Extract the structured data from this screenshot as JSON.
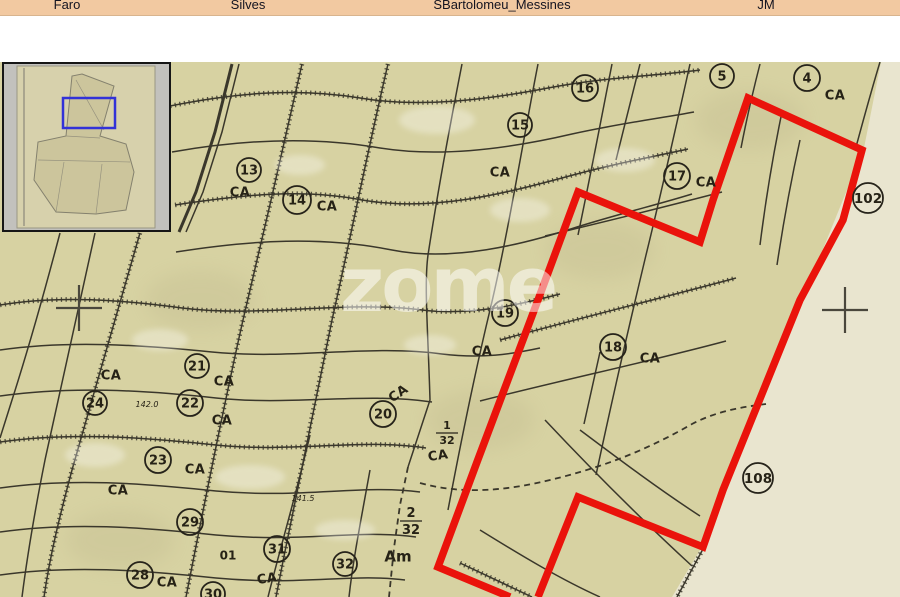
{
  "header": {
    "items": [
      {
        "label": "Faro"
      },
      {
        "label": "Silves"
      },
      {
        "label": "SBartolomeu_Messines"
      },
      {
        "label": "JM"
      }
    ],
    "bg_color": "#f2c9a1"
  },
  "minimap": {
    "highlight_color": "#3232d8"
  },
  "watermark": {
    "text": "zome"
  },
  "map": {
    "colors": {
      "paper": "#d7d2a2",
      "paper_light": "#e9e5cf",
      "line": "#3a372b",
      "cross": "#4a473c",
      "selection_red": "#ea130b"
    },
    "selection_outline_points": "538,597 578,497 703,547 723,490 800,300 843,220 862,150 748,98 713,200 700,242 578,192 538,300 477,462 438,567 510,597",
    "light_region_points": "881,62 900,62 900,597 672,597 703,545 864,148",
    "crosses": [
      {
        "x": 79,
        "y": 308
      },
      {
        "x": 845,
        "y": 310
      }
    ],
    "parcels": [
      {
        "n": "13",
        "x": 249,
        "y": 170,
        "r": 12
      },
      {
        "n": "14",
        "x": 297,
        "y": 200,
        "r": 14
      },
      {
        "n": "15",
        "x": 520,
        "y": 125,
        "r": 12
      },
      {
        "n": "16",
        "x": 585,
        "y": 88,
        "r": 13
      },
      {
        "n": "5",
        "x": 722,
        "y": 76,
        "r": 12
      },
      {
        "n": "4",
        "x": 807,
        "y": 78,
        "r": 13
      },
      {
        "n": "17",
        "x": 677,
        "y": 176,
        "r": 13
      },
      {
        "n": "102",
        "x": 868,
        "y": 198,
        "r": 15
      },
      {
        "n": "19",
        "x": 505,
        "y": 313,
        "r": 13
      },
      {
        "n": "18",
        "x": 613,
        "y": 347,
        "r": 13
      },
      {
        "n": "21",
        "x": 197,
        "y": 366,
        "r": 12
      },
      {
        "n": "24",
        "x": 95,
        "y": 403,
        "r": 12
      },
      {
        "n": "22",
        "x": 190,
        "y": 403,
        "r": 13
      },
      {
        "n": "20",
        "x": 383,
        "y": 414,
        "r": 13
      },
      {
        "n": "23",
        "x": 158,
        "y": 460,
        "r": 13
      },
      {
        "n": "29",
        "x": 190,
        "y": 522,
        "r": 13
      },
      {
        "n": "31",
        "x": 277,
        "y": 549,
        "r": 13
      },
      {
        "n": "32",
        "x": 345,
        "y": 564,
        "r": 12
      },
      {
        "n": "28",
        "x": 140,
        "y": 575,
        "r": 13
      },
      {
        "n": "30",
        "x": 213,
        "y": 594,
        "r": 12
      },
      {
        "n": "108",
        "x": 758,
        "y": 478,
        "r": 15
      }
    ],
    "ca_labels": [
      {
        "t": "CA",
        "x": 240,
        "y": 192,
        "rot": 0
      },
      {
        "t": "CA",
        "x": 327,
        "y": 206,
        "rot": 0
      },
      {
        "t": "CA",
        "x": 500,
        "y": 172,
        "rot": 0
      },
      {
        "t": "CA",
        "x": 706,
        "y": 182,
        "rot": 0
      },
      {
        "t": "CA",
        "x": 835,
        "y": 95,
        "rot": 0
      },
      {
        "t": "CA",
        "x": 650,
        "y": 358,
        "rot": 0
      },
      {
        "t": "CA",
        "x": 482,
        "y": 351,
        "rot": 0
      },
      {
        "t": "CA",
        "x": 224,
        "y": 381,
        "rot": 0
      },
      {
        "t": "CA",
        "x": 111,
        "y": 375,
        "rot": 0
      },
      {
        "t": "CA",
        "x": 222,
        "y": 420,
        "rot": 0
      },
      {
        "t": "CA",
        "x": 195,
        "y": 469,
        "rot": 0
      },
      {
        "t": "CA",
        "x": 118,
        "y": 490,
        "rot": 0
      },
      {
        "t": "CA",
        "x": 167,
        "y": 582,
        "rot": 0
      },
      {
        "t": "CA",
        "x": 267,
        "y": 578,
        "rot": -8
      },
      {
        "t": "CA",
        "x": 398,
        "y": 393,
        "rot": -35
      },
      {
        "t": "CA",
        "x": 438,
        "y": 455,
        "rot": -8
      }
    ],
    "annotations": [
      {
        "t": "142.0",
        "x": 147,
        "y": 404,
        "s": 8,
        "italic": true
      },
      {
        "t": "141.5",
        "x": 303,
        "y": 498,
        "s": 8,
        "italic": true
      },
      {
        "t": "01",
        "x": 228,
        "y": 555,
        "s": 12,
        "italic": false
      },
      {
        "t": "Am",
        "x": 398,
        "y": 556,
        "s": 15,
        "italic": false
      }
    ],
    "fractions": [
      {
        "num": "1",
        "den": "32",
        "x": 447,
        "y": 433,
        "s": 11
      },
      {
        "num": "2",
        "den": "32",
        "x": 411,
        "y": 521,
        "s": 13
      }
    ],
    "lines": [
      {
        "d": "M232,64 L215,132 L196,192 L179,232",
        "k": "thick"
      },
      {
        "d": "M239,64 L222,132 L203,192 L186,232",
        "k": "thin"
      },
      {
        "d": "M140,233 C120,300 95,390 72,470 C60,515 50,555 44,597",
        "k": "tick"
      },
      {
        "d": "M95,233 C80,300 62,380 45,460 C35,510 28,550 22,597",
        "k": "thin"
      },
      {
        "d": "M60,233 C45,290 28,350 12,400 L0,438",
        "k": "thin"
      },
      {
        "d": "M302,64 C285,140 262,240 243,320 C225,400 205,500 186,597",
        "k": "tick"
      },
      {
        "d": "M388,64 C370,140 350,240 332,320 C315,400 295,500 276,597",
        "k": "tick"
      },
      {
        "d": "M462,64 C450,125 438,190 428,255 C424,285 428,330 430,400 L408,467",
        "k": "thin"
      },
      {
        "d": "M408,467 L400,505 L394,548 L389,597",
        "k": "dash"
      },
      {
        "d": "M538,64 C524,135 508,235 490,310 C478,360 465,420 448,510",
        "k": "thin"
      },
      {
        "d": "M612,64 C601,120 590,178 578,235",
        "k": "thin"
      },
      {
        "d": "M640,64 C632,95 624,128 616,160",
        "k": "thin"
      },
      {
        "d": "M690,64 C678,118 662,190 646,255 C630,322 612,400 596,475",
        "k": "thin"
      },
      {
        "d": "M760,64 C752,95 746,122 741,148",
        "k": "thin"
      },
      {
        "d": "M880,62 C870,95 862,125 856,147",
        "k": "thin"
      },
      {
        "d": "M310,435 C296,495 281,545 268,597",
        "k": "thin"
      },
      {
        "d": "M370,470 C361,520 353,560 349,597",
        "k": "thin"
      },
      {
        "d": "M170,106 C240,92 300,88 360,98 C420,108 485,100 548,88 C605,77 655,76 700,70",
        "k": "tick"
      },
      {
        "d": "M172,152 C240,140 312,136 380,148 C442,158 512,148 572,134 C622,123 662,118 694,112",
        "k": "thin"
      },
      {
        "d": "M175,205 C242,195 302,188 362,200 C432,212 502,194 562,178 C612,164 652,157 688,149",
        "k": "tick"
      },
      {
        "d": "M176,252 C252,240 322,236 392,250 C452,262 522,245 577,227 C622,213 660,204 692,194",
        "k": "thin"
      },
      {
        "d": "M0,305 C60,295 122,300 182,308 C262,318 342,300 422,310 C472,316 522,304 560,294",
        "k": "tick"
      },
      {
        "d": "M0,350 C70,340 142,345 212,352 C292,360 372,344 442,354 C482,359 512,354 540,348",
        "k": "thin"
      },
      {
        "d": "M0,396 C70,386 142,390 216,398 C292,406 362,392 432,402",
        "k": "thin"
      },
      {
        "d": "M0,442 C70,432 142,437 216,445 C292,453 362,438 426,448",
        "k": "tick"
      },
      {
        "d": "M0,488 C70,478 142,483 216,491 C302,499 362,484 420,492",
        "k": "thin"
      },
      {
        "d": "M0,532 C70,522 142,527 216,535 C302,543 356,529 416,537",
        "k": "thin"
      },
      {
        "d": "M0,575 C70,565 142,570 216,578 C302,586 352,573 405,580",
        "k": "thin"
      },
      {
        "d": "M545,236 C612,220 672,205 722,192",
        "k": "thin"
      },
      {
        "d": "M500,340 C580,318 662,298 736,278",
        "k": "tick"
      },
      {
        "d": "M480,401 C562,380 652,361 726,341",
        "k": "thin"
      },
      {
        "d": "M545,420 C592,470 642,520 692,566",
        "k": "thin"
      },
      {
        "d": "M480,530 C522,556 562,580 600,597",
        "k": "thin"
      },
      {
        "d": "M460,563 L532,597",
        "k": "tick"
      },
      {
        "d": "M703,549 L677,597",
        "k": "tick"
      },
      {
        "d": "M782,112 C772,160 765,205 760,245",
        "k": "thin"
      },
      {
        "d": "M800,140 C790,185 783,225 777,265",
        "k": "thin"
      },
      {
        "d": "M420,483 C470,497 520,488 562,477 C612,464 652,447 692,424 C717,411 742,407 766,404",
        "k": "dash"
      },
      {
        "d": "M600,352 L584,424",
        "k": "thin"
      },
      {
        "d": "M580,430 C620,460 660,490 700,516",
        "k": "thin"
      }
    ],
    "patches": [
      {
        "x": 437,
        "y": 120,
        "rx": 38,
        "ry": 14
      },
      {
        "x": 300,
        "y": 165,
        "rx": 25,
        "ry": 10
      },
      {
        "x": 520,
        "y": 210,
        "rx": 30,
        "ry": 12
      },
      {
        "x": 625,
        "y": 160,
        "rx": 30,
        "ry": 12
      },
      {
        "x": 160,
        "y": 340,
        "rx": 28,
        "ry": 11
      },
      {
        "x": 430,
        "y": 345,
        "rx": 26,
        "ry": 10
      },
      {
        "x": 95,
        "y": 455,
        "rx": 30,
        "ry": 12
      },
      {
        "x": 250,
        "y": 477,
        "rx": 35,
        "ry": 12
      },
      {
        "x": 345,
        "y": 530,
        "rx": 30,
        "ry": 10
      }
    ]
  }
}
